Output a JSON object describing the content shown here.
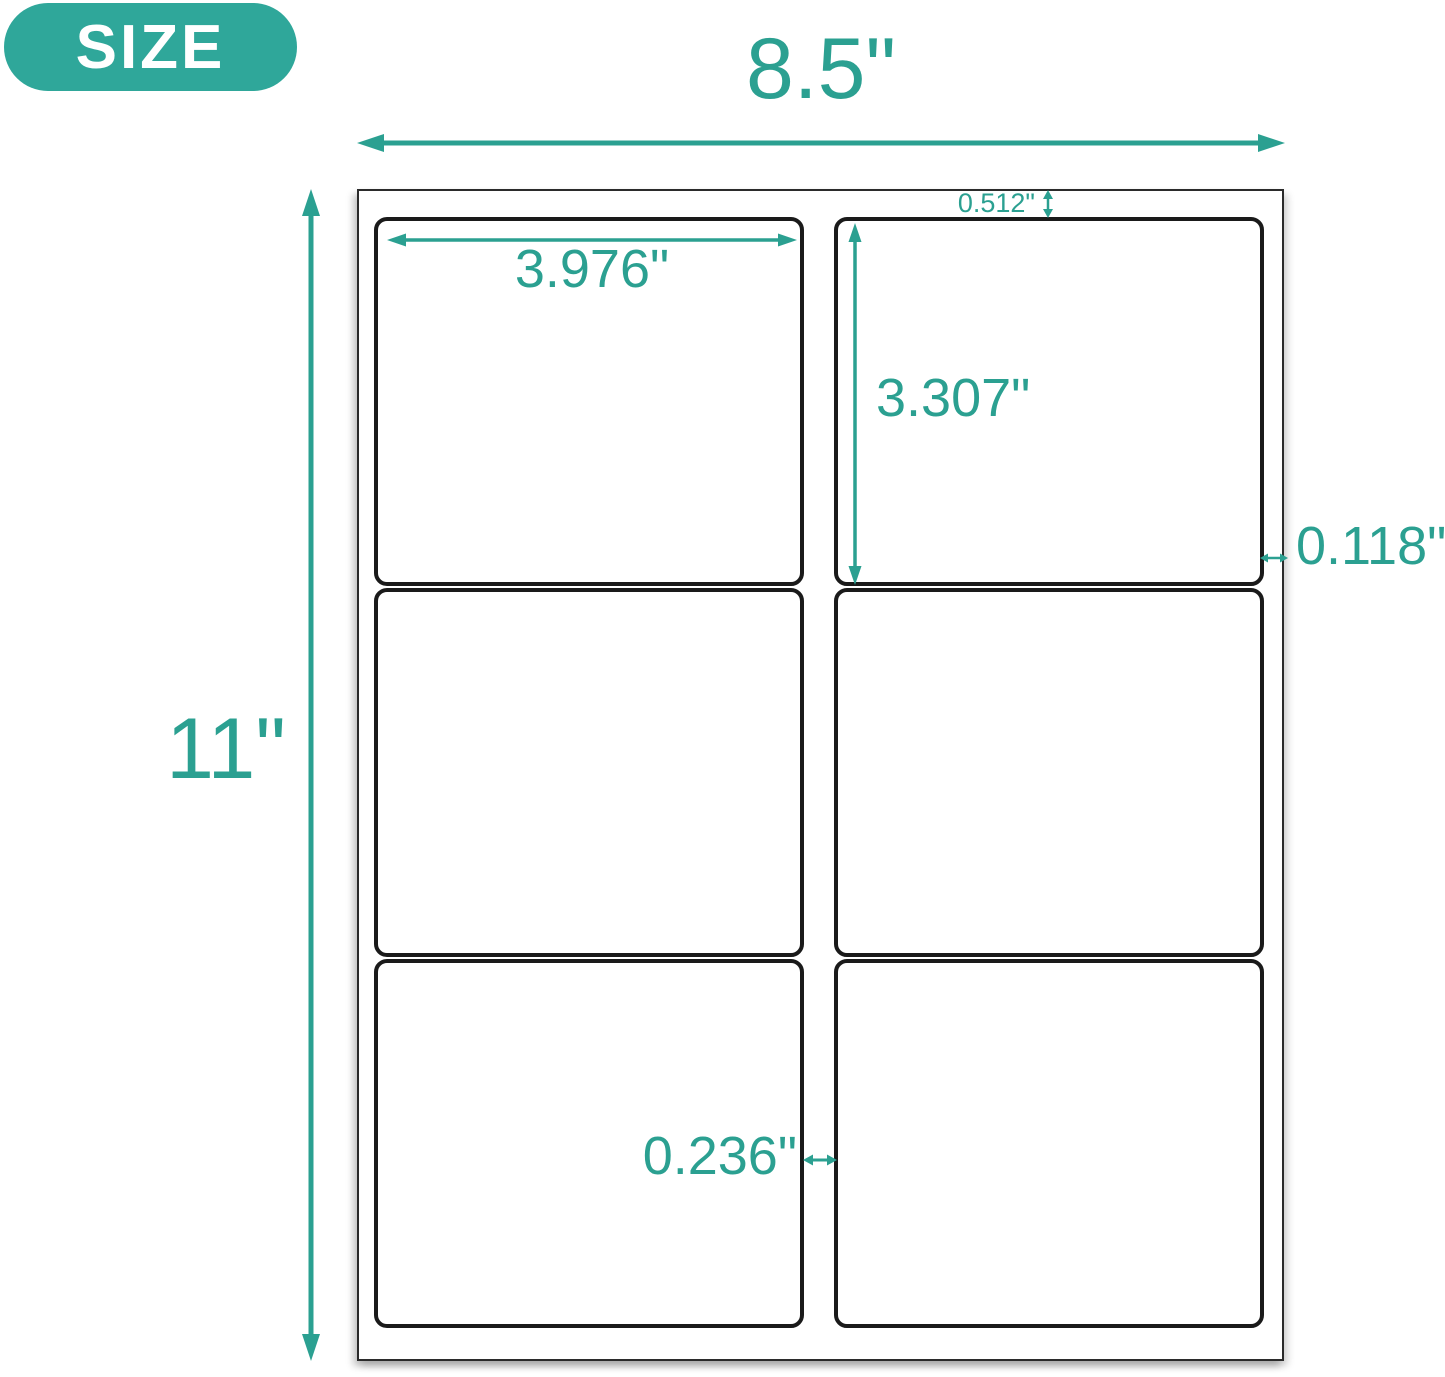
{
  "badge": {
    "label": "SIZE"
  },
  "sheet": {
    "grid": {
      "rows": 3,
      "columns": 2,
      "label_count": 6
    }
  },
  "dimensions": {
    "sheet_width": "8.5\"",
    "sheet_height": "11\"",
    "label_width": "3.976\"",
    "label_height": "3.307\"",
    "top_margin": "0.512\"",
    "side_margin": "0.118\"",
    "column_gap": "0.236\""
  },
  "colors": {
    "accent_teal": "#2BA091",
    "badge_teal": "#2FA79A",
    "label_border": "#1A1A1A",
    "sheet_border": "#2B2B2B"
  }
}
